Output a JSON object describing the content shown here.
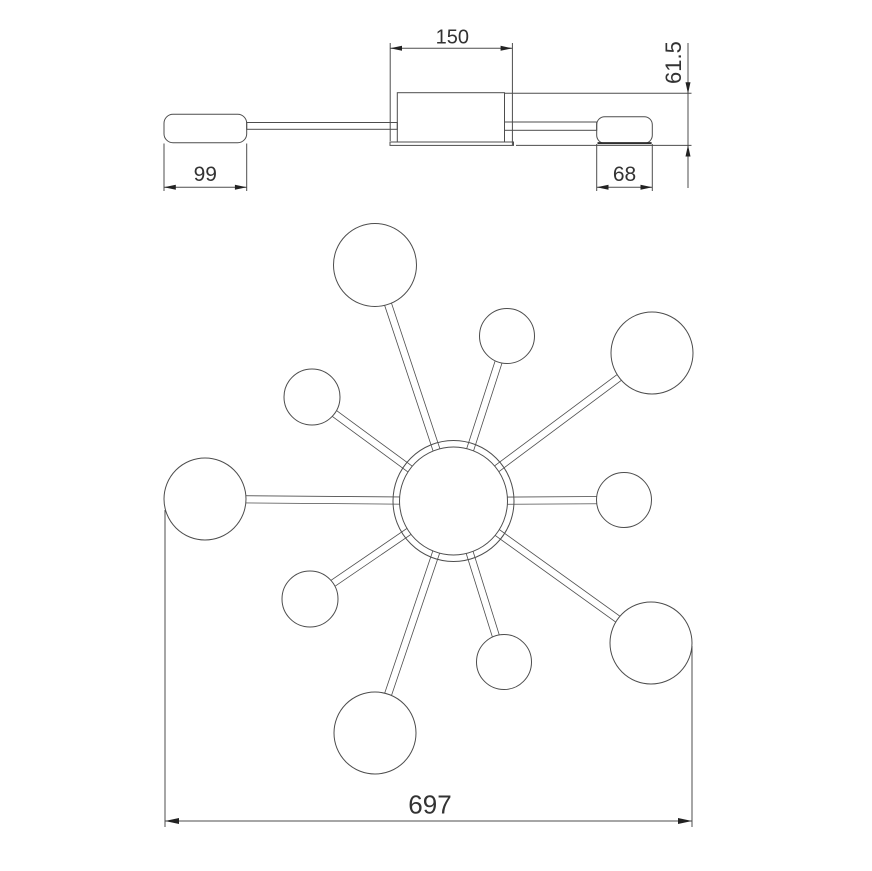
{
  "colors": {
    "background": "#ffffff",
    "line": "#4d4d4d",
    "text": "#333333",
    "arrow": "#222222"
  },
  "side_view": {
    "plate_width": "150",
    "fixture_height": "61.5",
    "left_shade_width": "99",
    "right_shade_width": "68"
  },
  "top_view": {
    "overall_diameter": "697"
  }
}
